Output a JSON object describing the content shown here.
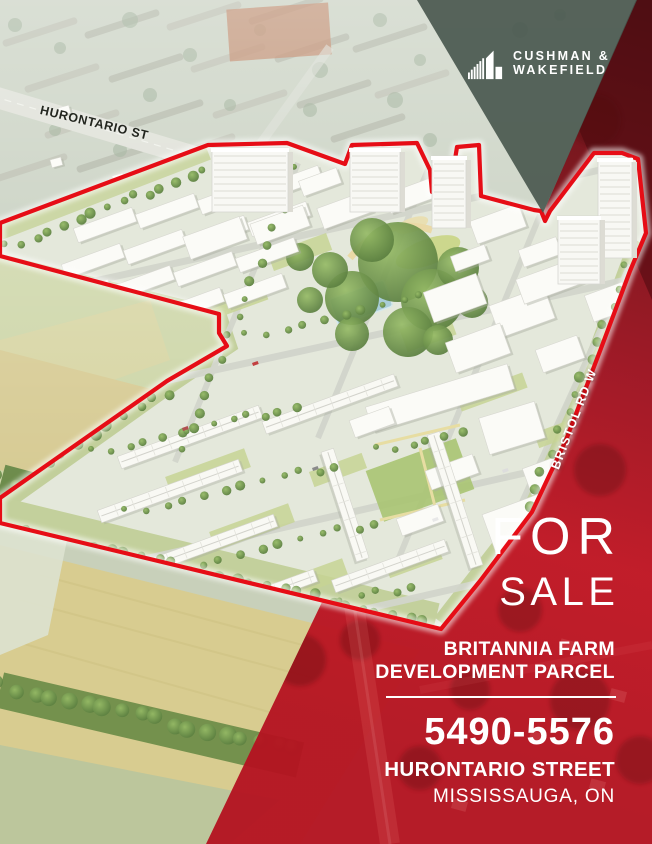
{
  "brand": {
    "line1": "CUSHMAN &",
    "line2": "WAKEFIELD",
    "logo_icon": "building-bars-icon"
  },
  "map_labels": {
    "top_street": "HURONTARIO ST",
    "right_street": "BRISTOL RD W"
  },
  "listing": {
    "status_line1": "FOR",
    "status_line2": "SALE",
    "name_line1": "BRITANNIA FARM",
    "name_line2": "DEVELOPMENT PARCEL",
    "address_range": "5490-5576",
    "address_street": "HURONTARIO STREET",
    "address_city": "MISSISSAUGA, ON"
  },
  "colors": {
    "accent_red": "#C01220",
    "boundary_red": "#E60D16",
    "wedge_green": "#47554D",
    "text_white": "#FFFFFF"
  }
}
